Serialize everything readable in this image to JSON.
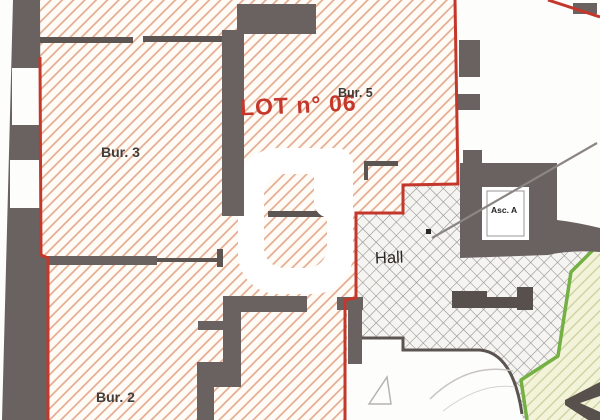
{
  "plan": {
    "lot_label": "LOT n° 06",
    "rooms": {
      "bur3": "Bur. 3",
      "bur5": "Bur. 5",
      "bur2": "Bur. 2",
      "hall": "Hall",
      "elevator": "Asc. A"
    },
    "colors": {
      "lot_boundary_red": "#c4382c",
      "lot_hatch_peach": "#e3aa8e",
      "wall_gray": "#6a6260",
      "common_boundary_green": "#74b043",
      "adjacent_zone_yellow": "#f2f3d8"
    }
  }
}
